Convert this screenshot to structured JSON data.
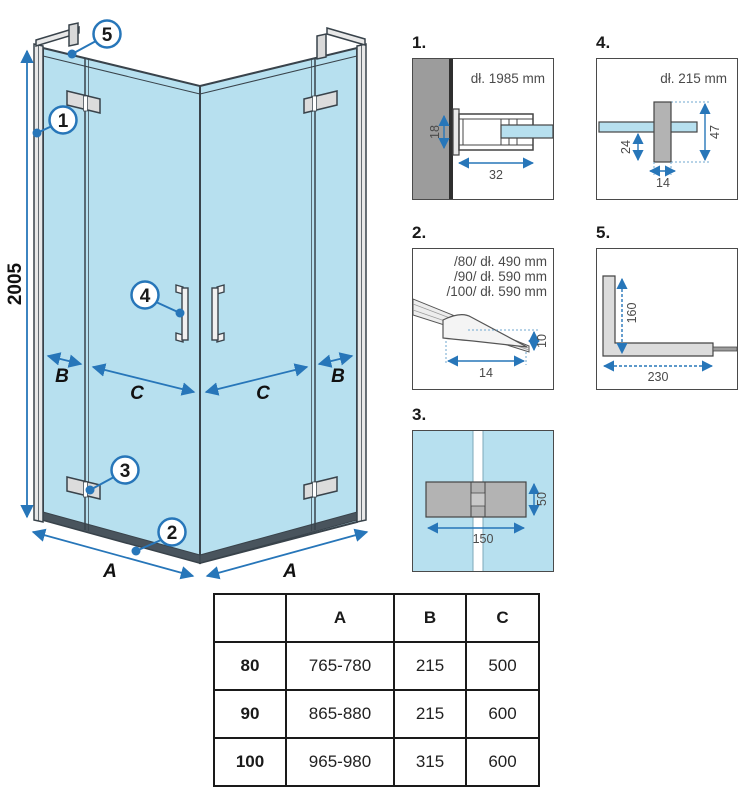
{
  "main_view": {
    "height_dim": "2005",
    "labels": {
      "b_left": "B",
      "c_left": "C",
      "c_right": "C",
      "b_right": "B",
      "a_left": "A",
      "a_right": "A"
    },
    "callouts": {
      "c1": "1",
      "c2": "2",
      "c3": "3",
      "c4": "4",
      "c5": "5"
    }
  },
  "details": {
    "d1": {
      "label": "1.",
      "title": "dł. 1985 mm",
      "dim_height": "18",
      "dim_width": "32"
    },
    "d2": {
      "label": "2.",
      "line1": "/80/ dł. 490 mm",
      "line2": "/90/ dł. 590 mm",
      "line3": "/100/ dł. 590 mm",
      "dim_height": "10",
      "dim_width": "14"
    },
    "d3": {
      "label": "3.",
      "dim_width": "150",
      "dim_height": "50"
    },
    "d4": {
      "label": "4.",
      "title": "dł. 215 mm",
      "dim_offset": "24",
      "dim_height": "47",
      "dim_width": "14"
    },
    "d5": {
      "label": "5.",
      "dim_height": "160",
      "dim_width": "230"
    }
  },
  "table": {
    "corner": "",
    "headers": [
      "A",
      "B",
      "C"
    ],
    "rows": [
      {
        "size": "80",
        "a": "765-780",
        "b": "215",
        "c": "500"
      },
      {
        "size": "90",
        "a": "865-880",
        "b": "215",
        "c": "600"
      },
      {
        "size": "100",
        "a": "965-980",
        "b": "315",
        "c": "600"
      }
    ]
  },
  "colors": {
    "glass_blue": "#b7e0ef",
    "dimension_blue": "#2776b9",
    "outline_dark": "#39434b",
    "wall_gray": "#9c9c9c",
    "hinge_gray": "#b3b3b3",
    "text_dark": "#1a1a1a",
    "detail_text_gray": "#4a4a4a"
  }
}
